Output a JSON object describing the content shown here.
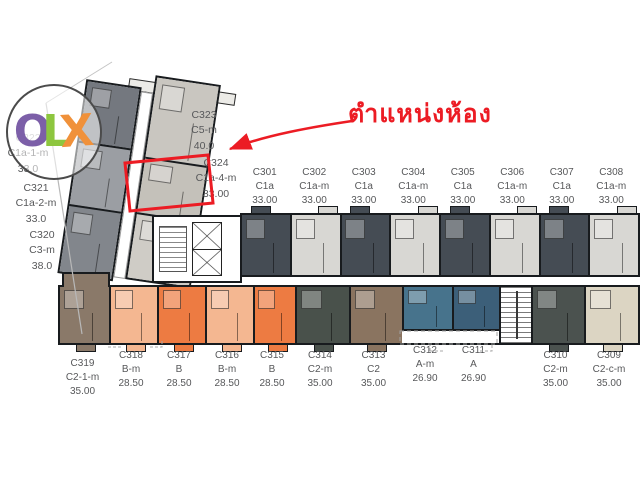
{
  "watermark": {
    "letters": [
      {
        "char": "O",
        "color": "#7c5fa8"
      },
      {
        "char": "L",
        "color": "#8dc63f"
      },
      {
        "char": "X",
        "color": "#f0913a"
      }
    ]
  },
  "annotation": {
    "label": "ตำแหน่งห้อง",
    "color": "#ec1c24",
    "target": "C324"
  },
  "wing_units": {
    "c322": {
      "id": "C322",
      "type": "C1a-1-m",
      "area": "33.0",
      "color": "#74787f"
    },
    "c321": {
      "id": "C321",
      "type": "C1a-2-m",
      "area": "33.0",
      "color": "#9b9ea3"
    },
    "c320": {
      "id": "C320",
      "type": "C3-m",
      "area": "38.0",
      "color": "#82868c"
    },
    "c323": {
      "id": "C323",
      "type": "C5-m",
      "area": "40.0",
      "color": "#c9c6c0"
    },
    "c324": {
      "id": "C324",
      "type": "C1a-4-m",
      "area": "33.00",
      "color": "#c4c1ba"
    },
    "c325_fill_color": "#cfccc6"
  },
  "top_row": [
    {
      "id": "C301",
      "type": "C1a",
      "area": "33.00",
      "color": "#454c54"
    },
    {
      "id": "C302",
      "type": "C1a-m",
      "area": "33.00",
      "color": "#d8d7d3"
    },
    {
      "id": "C303",
      "type": "C1a",
      "area": "33.00",
      "color": "#454c54"
    },
    {
      "id": "C304",
      "type": "C1a-m",
      "area": "33.00",
      "color": "#d8d7d3"
    },
    {
      "id": "C305",
      "type": "C1a",
      "area": "33.00",
      "color": "#454c54"
    },
    {
      "id": "C306",
      "type": "C1a-m",
      "area": "33.00",
      "color": "#d8d7d3"
    },
    {
      "id": "C307",
      "type": "C1a",
      "area": "33.00",
      "color": "#454c54"
    },
    {
      "id": "C308",
      "type": "C1a-m",
      "area": "33.00",
      "color": "#d8d7d3"
    }
  ],
  "bottom_row": [
    {
      "id": "C319",
      "type": "C2-1-m",
      "area": "35.00",
      "color": "#8a7969"
    },
    {
      "id": "C318",
      "type": "B-m",
      "area": "28.50",
      "color": "#f4b791"
    },
    {
      "id": "C317",
      "type": "B",
      "area": "28.50",
      "color": "#ed7b42"
    },
    {
      "id": "C316",
      "type": "B-m",
      "area": "28.50",
      "color": "#f4b791"
    },
    {
      "id": "C315",
      "type": "B",
      "area": "28.50",
      "color": "#ed7b42"
    },
    {
      "id": "C314",
      "type": "C2-m",
      "area": "35.00",
      "color": "#49514b"
    },
    {
      "id": "C313",
      "type": "C2",
      "area": "35.00",
      "color": "#8a7460"
    },
    {
      "id": "C312",
      "type": "A-m",
      "area": "26.90",
      "color": "#47738c"
    },
    {
      "id": "C311",
      "type": "A",
      "area": "26.90",
      "color": "#3c5f79"
    },
    {
      "id": "C310",
      "type": "C2-m",
      "area": "35.00",
      "color": "#4b524f"
    },
    {
      "id": "C309",
      "type": "C2-c-m",
      "area": "35.00",
      "color": "#dcd5c3"
    }
  ]
}
